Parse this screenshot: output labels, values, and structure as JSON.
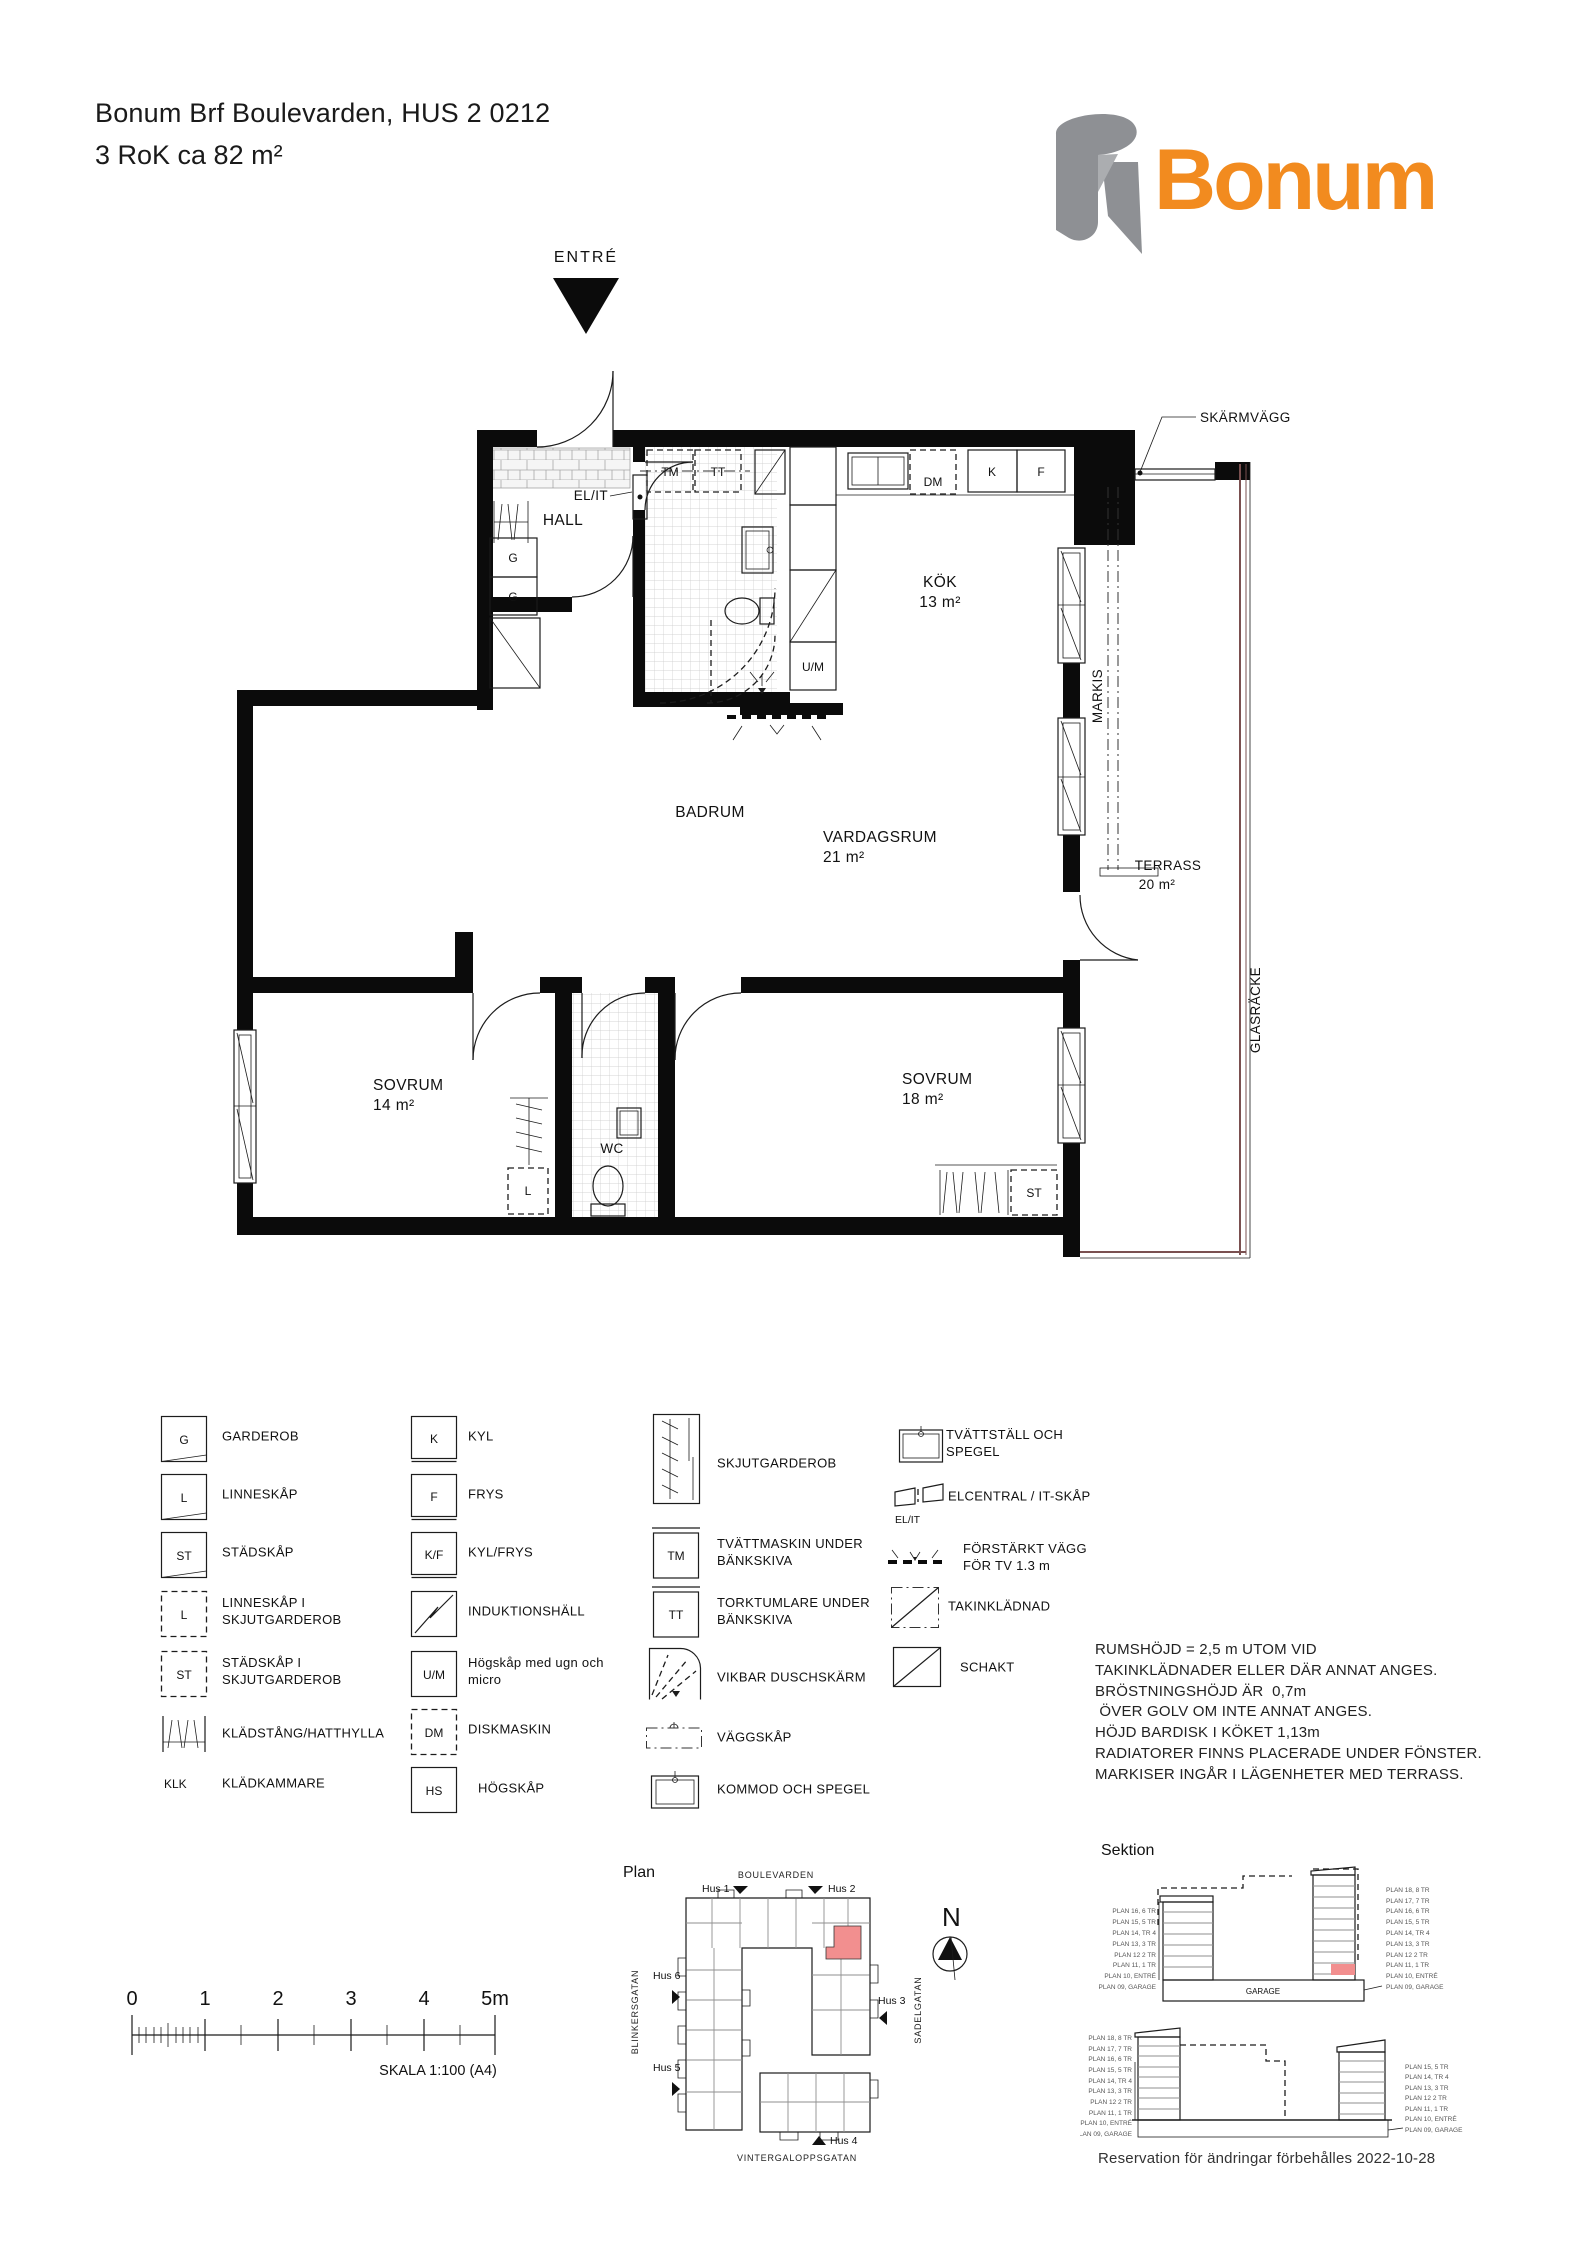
{
  "header": {
    "title_line1": "Bonum Brf Boulevarden, HUS 2 0212",
    "title_line2": "3 RoK ca  82 m²",
    "logo_text": "Bonum"
  },
  "plan": {
    "entry": "ENTRÉ",
    "hall": "HALL",
    "badrum": "BADRUM",
    "kok": "KÖK",
    "kok_area": "13 m²",
    "vardagsrum": "VARDAGSRUM",
    "vardagsrum_area": "21 m²",
    "terrass": "TERRASS",
    "terrass_area": "20 m²",
    "sovrum14": "SOVRUM",
    "sovrum14_area": "14 m²",
    "sovrum18": "SOVRUM",
    "sovrum18_area": "18 m²",
    "wc": "WC",
    "skarmvagg": "SKÄRMVÄGG",
    "markis": "MARKIS",
    "glasracke": "GLASRÄCKE",
    "el_it": "EL/IT",
    "tm": "TM",
    "tt": "TT",
    "dm": "DM",
    "k": "K",
    "f": "F",
    "um": "U/M",
    "g": "G",
    "l": "L",
    "st": "ST"
  },
  "legend": {
    "col1": [
      {
        "sym": "G",
        "label": "GARDEROB"
      },
      {
        "sym": "L",
        "label": "LINNESKÅP"
      },
      {
        "sym": "ST",
        "label": "STÄDSKÅP"
      },
      {
        "sym": "L",
        "label": "LINNESKÅP I SKJUTGARDEROB"
      },
      {
        "sym": "ST",
        "label": "STÄDSKÅP I SKJUTGARDEROB"
      },
      {
        "sym": "",
        "label": "KLÄDSTÅNG/HATTHYLLA"
      },
      {
        "sym": "KLK",
        "label": "KLÄDKAMMARE"
      }
    ],
    "col2": [
      {
        "sym": "K",
        "label": "KYL"
      },
      {
        "sym": "F",
        "label": "FRYS"
      },
      {
        "sym": "K/F",
        "label": "KYL/FRYS"
      },
      {
        "sym": "",
        "label": "INDUKTIONSHÄLL"
      },
      {
        "sym": "U/M",
        "label": "Högskåp med ugn och micro"
      },
      {
        "sym": "DM",
        "label": "DISKMASKIN"
      },
      {
        "sym": "HS",
        "label": "HÖGSKÅP"
      }
    ],
    "col3": [
      {
        "sym": "",
        "label": "SKJUTGARDEROB"
      },
      {
        "sym": "TM",
        "label": "TVÄTTMASKIN UNDER BÄNKSKIVA"
      },
      {
        "sym": "TT",
        "label": "TORKTUMLARE UNDER BÄNKSKIVA"
      },
      {
        "sym": "",
        "label": "VIKBAR DUSCHSKÄRM"
      },
      {
        "sym": "",
        "label": "VÄGGSKÅP"
      },
      {
        "sym": "",
        "label": "KOMMOD OCH SPEGEL"
      }
    ],
    "col4": [
      {
        "sym": "",
        "label": "TVÄTTSTÄLL OCH SPEGEL"
      },
      {
        "sym": "EL/IT",
        "label": "ELCENTRAL / IT-SKÅP"
      },
      {
        "sym": "",
        "label": "FÖRSTÄRKT VÄGG FÖR TV 1.3 m"
      },
      {
        "sym": "",
        "label": "TAKINKLÄDNAD"
      },
      {
        "sym": "",
        "label": "SCHAKT"
      }
    ]
  },
  "notes": {
    "l1": "RUMSHÖJD = 2,5 m UTOM VID",
    "l2": "TAKINKLÄDNADER ELLER DÄR ANNAT ANGES.",
    "l3": "BRÖSTNINGSHÖJD ÄR  0,7m",
    "l4": " ÖVER GOLV OM INTE ANNAT ANGES.",
    "l5": "HÖJD BARDISK I KÖKET 1,13m",
    "l6": "RADIATORER FINNS PLACERADE UNDER FÖNSTER.",
    "l7": "MARKISER INGÅR I LÄGENHETER MED TERRASS."
  },
  "scalebar": {
    "n0": "0",
    "n1": "1",
    "n2": "2",
    "n3": "3",
    "n4": "4",
    "n5": "5m",
    "caption": "SKALA 1:100 (A4)"
  },
  "siteplan": {
    "title": "Plan",
    "street_top": "BOULEVARDEN",
    "street_left": "BLINKERSGATAN",
    "street_right": "SADELGATAN",
    "street_bottom": "VINTERGALOPPSGATAN",
    "hus1": "Hus 1",
    "hus2": "Hus 2",
    "hus3": "Hus 3",
    "hus4": "Hus 4",
    "hus5": "Hus 5",
    "hus6": "Hus 6",
    "north": "N"
  },
  "sektion": {
    "title": "Sektion",
    "garage": "GARAGE",
    "s1_left": [
      "PLAN 16, 6 TR",
      "PLAN 15, 5 TR",
      "PLAN 14, TR 4",
      "PLAN 13, 3 TR",
      "PLAN 12 2 TR",
      "PLAN 11, 1 TR",
      "PLAN 10, ENTRÉ",
      "PLAN 09, GARAGE"
    ],
    "s1_right": [
      "PLAN 18, 8 TR",
      "PLAN 17, 7 TR",
      "PLAN 16, 6 TR",
      "PLAN 15, 5 TR",
      "PLAN 14, TR 4",
      "PLAN 13, 3 TR",
      "PLAN 12 2 TR",
      "PLAN 11, 1 TR",
      "PLAN 10, ENTRÉ",
      "PLAN 09, GARAGE"
    ],
    "s2_left": [
      "PLAN 18, 8 TR",
      "PLAN 17, 7 TR",
      "PLAN 16, 6 TR",
      "PLAN 15, 5 TR",
      "PLAN 14, TR 4",
      "PLAN 13, 3 TR",
      "PLAN 12 2 TR",
      "PLAN 11, 1 TR",
      "PLAN 10, ENTRÉ",
      "PLAN 09, GARAGE"
    ],
    "s2_right": [
      "PLAN 15, 5 TR",
      "PLAN 14, TR 4",
      "PLAN 13, 3 TR",
      "PLAN 12 2 TR",
      "PLAN 11, 1 TR",
      "PLAN 10, ENTRÉ",
      "PLAN 09, GARAGE"
    ]
  },
  "footer": {
    "text": "Reservation för ändringar förbehålles 2022-10-28"
  },
  "colors": {
    "accent_orange": "#F28B1F",
    "highlight": "#F28F8F",
    "logo_gray": "#8E9094",
    "railing": "#7A5050"
  }
}
